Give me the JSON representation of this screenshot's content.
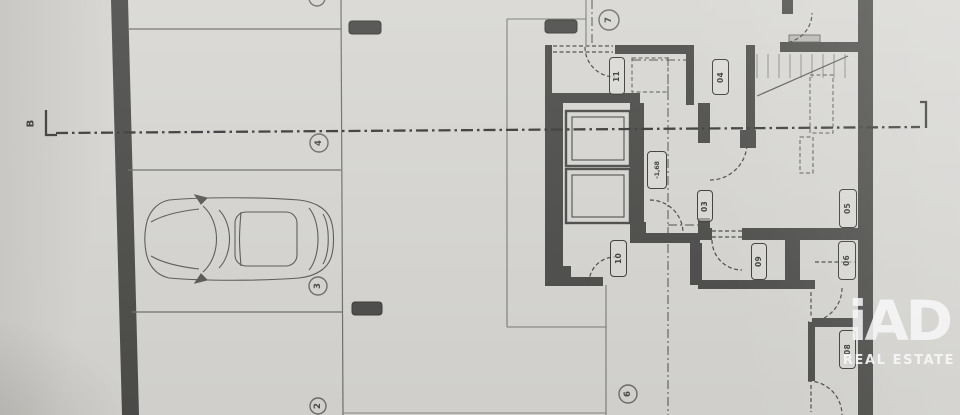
{
  "page": {
    "kind": "basement-floor-plan-photo"
  },
  "section_marker": {
    "label": "B"
  },
  "parking": {
    "stalls": [
      {
        "number": "2"
      },
      {
        "number": "3"
      },
      {
        "number": "4"
      }
    ],
    "car_in_stall": "3"
  },
  "axis_nodes": [
    {
      "number": "7"
    },
    {
      "number": "6"
    }
  ],
  "rooms": {
    "r03": "03",
    "r04": "04",
    "r05": "05",
    "r06": "06",
    "r08": "08",
    "r09": "09",
    "r10": "10",
    "r11": "11"
  },
  "elevation": {
    "marker": "-1,68"
  },
  "watermark": {
    "brand": "iAD",
    "tagline": "REAL ESTATE"
  },
  "colors": {
    "paper": "#d8d7d3",
    "wall": "#4d4d4b",
    "thin_line": "#7b7a77",
    "dash_line": "#4a4a48",
    "watermark": "#ffffff"
  }
}
